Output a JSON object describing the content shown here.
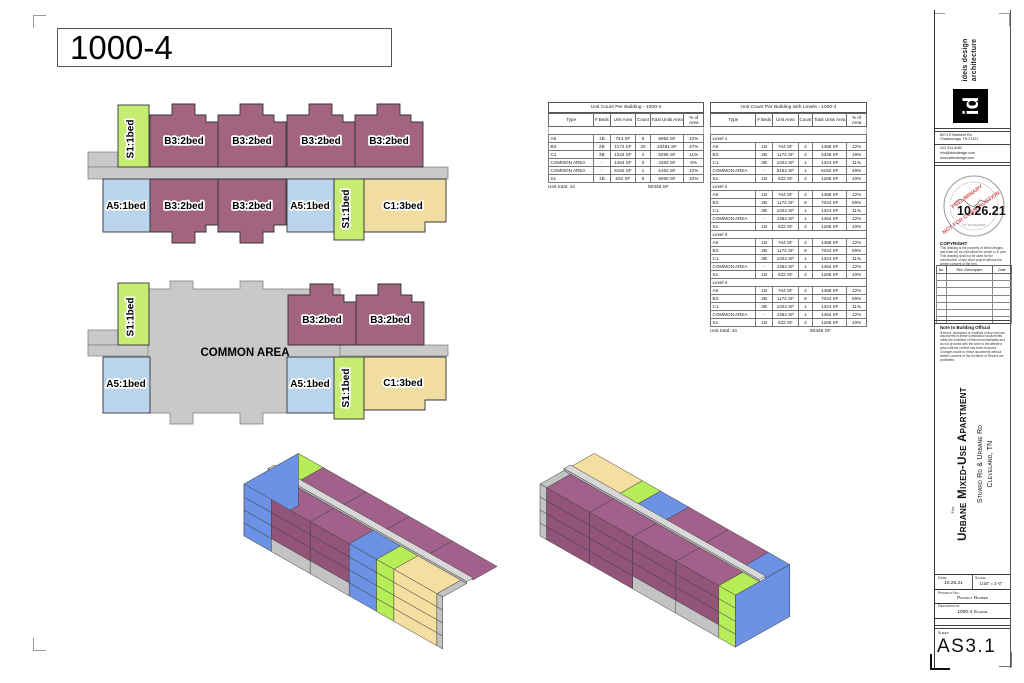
{
  "sheet_title": "1000-4",
  "units": {
    "s1": "S1:1bed",
    "a5": "A5:1bed",
    "b3": "B3:2bed",
    "c1": "C1:3bed",
    "common": "COMMON AREA"
  },
  "tables": {
    "building": {
      "title": "Unit Count Per Building - 1000-4",
      "headers": [
        "Type",
        "# Beds",
        "Unit Area",
        "Count",
        "Total Units Area",
        "% of Area"
      ],
      "rows": [
        [
          "A5",
          "1B",
          "744 SF",
          "8",
          "5954 SF",
          "12%"
        ],
        [
          "B3",
          "2B",
          "1174 SF",
          "20",
          "23481 SF",
          "47%"
        ],
        [
          "C1",
          "3B",
          "1324 SF",
          "4",
          "5296 SF",
          "11%"
        ],
        [
          "COMMON AREA",
          "-",
          "1464 SF",
          "3",
          "4393 SF",
          "9%"
        ],
        [
          "COMMON AREA",
          "-",
          "6162 SF",
          "1",
          "6162 SF",
          "12%"
        ],
        [
          "S1",
          "1B",
          "632 SF",
          "8",
          "5060 SF",
          "10%"
        ]
      ],
      "footer_label": "Unit total: 44",
      "footer_total": "50346 SF"
    },
    "levels": {
      "title": "Unit Count Per Building with Levels - 1000-4",
      "headers": [
        "Type",
        "# Beds",
        "Unit Area",
        "Count",
        "Total Units Area",
        "% of Area"
      ],
      "groups": [
        {
          "label": "Level 1",
          "rows": [
            [
              "A5",
              "1B",
              "744 SF",
              "2",
              "1488 SF",
              "12%"
            ],
            [
              "B3",
              "2B",
              "1174 SF",
              "2",
              "2348 SF",
              "19%"
            ],
            [
              "C1",
              "3B",
              "1324 SF",
              "1",
              "1324 SF",
              "11%"
            ],
            [
              "COMMON AREA",
              "-",
              "6162 SF",
              "1",
              "6162 SF",
              "49%"
            ],
            [
              "S1",
              "1B",
              "632 SF",
              "2",
              "1265 SF",
              "10%"
            ]
          ]
        },
        {
          "label": "Level 2",
          "rows": [
            [
              "A5",
              "1B",
              "744 SF",
              "2",
              "1488 SF",
              "12%"
            ],
            [
              "B3",
              "2B",
              "1174 SF",
              "6",
              "7044 SF",
              "56%"
            ],
            [
              "C1",
              "3B",
              "1324 SF",
              "1",
              "1324 SF",
              "11%"
            ],
            [
              "COMMON AREA",
              "-",
              "1464 SF",
              "1",
              "1464 SF",
              "12%"
            ],
            [
              "S1",
              "1B",
              "632 SF",
              "2",
              "1265 SF",
              "10%"
            ]
          ]
        },
        {
          "label": "Level 3",
          "rows": [
            [
              "A5",
              "1B",
              "744 SF",
              "2",
              "1488 SF",
              "12%"
            ],
            [
              "B3",
              "2B",
              "1174 SF",
              "6",
              "7044 SF",
              "56%"
            ],
            [
              "C1",
              "3B",
              "1324 SF",
              "1",
              "1324 SF",
              "11%"
            ],
            [
              "COMMON AREA",
              "-",
              "1464 SF",
              "1",
              "1464 SF",
              "12%"
            ],
            [
              "S1",
              "1B",
              "632 SF",
              "2",
              "1265 SF",
              "10%"
            ]
          ]
        },
        {
          "label": "Level 4",
          "rows": [
            [
              "A5",
              "1B",
              "744 SF",
              "2",
              "1488 SF",
              "12%"
            ],
            [
              "B3",
              "2B",
              "1174 SF",
              "6",
              "7044 SF",
              "56%"
            ],
            [
              "C1",
              "3B",
              "1324 SF",
              "1",
              "1324 SF",
              "11%"
            ],
            [
              "COMMON AREA",
              "-",
              "1464 SF",
              "1",
              "1464 SF",
              "12%"
            ],
            [
              "S1",
              "1B",
              "632 SF",
              "2",
              "1265 SF",
              "10%"
            ]
          ]
        }
      ],
      "footer_label": "Unit total: 44",
      "footer_total": "50346 SF"
    }
  },
  "titleblock": {
    "firm": {
      "name_line1": "ideis design",
      "name_line2": "architecture",
      "logo": "id",
      "address1": "6074 E Brainerd Rd",
      "address2": "Chattanooga, TN 37421",
      "phone": "423.314.8182",
      "email": "info@ideisdesign.com",
      "web": "www.ideisdesign.com"
    },
    "stamp": {
      "date": "10.26.21",
      "line1": "PRELIMINARY",
      "line2": "NOT FOR CONSTRUCTION",
      "seal": "OF TENNESSEE"
    },
    "copyright": {
      "heading": "COPYRIGHT",
      "body": "This drawing is the property of Ideis Designs, and shall not be reproduced in whole or in part. This drawing shall not be used for the construction of any other project without the written consent of the firm."
    },
    "revisions": {
      "col_no": "No.",
      "col_desc": "Rev. Description",
      "col_date": "Date"
    },
    "note": {
      "heading": "Note to Building Official",
      "body": "If errors, omissions or conflicts of any kind are discovered in these construction documents, notify the Architect of Record immediately and do not proceed with the work in the affected area until the conflict has been resolved. Changes made to these documents without written consent of the Architect of Record are prohibited."
    },
    "project": {
      "for_label": "For",
      "name": "Urbane Mixed-Use Apartment",
      "road": "Stuard Rd & Urbane Rd",
      "city": "Cleveland, TN"
    },
    "info": {
      "date_label": "Date:",
      "date": "10.26.21",
      "scale_label": "Scale:",
      "scale": "1/16\" = 1'-0\"",
      "project_label": "Project No.:",
      "project_value": "Project Number",
      "desc_label": "Description:",
      "desc_value": "1000-4 Scheme",
      "sheet_label": "Sheet:",
      "sheet_value": "AS3.1"
    }
  },
  "colors": {
    "plan_purple": "#a3647f",
    "plan_blue": "#b9d4ec",
    "plan_green": "#c6ec72",
    "plan_yellow": "#f1dda1",
    "plan_gray": "#c9c9c9",
    "axon_purple_front": "#93547a",
    "axon_purple_roof": "#a2618a",
    "axon_blue": "#6b92e4",
    "axon_green": "#b7ee58",
    "axon_yellow": "#f4dfa0",
    "axon_gray": "#c3c3c3",
    "axon_corridor": "#d8d8d8",
    "stamp_red": "#cc3333"
  }
}
